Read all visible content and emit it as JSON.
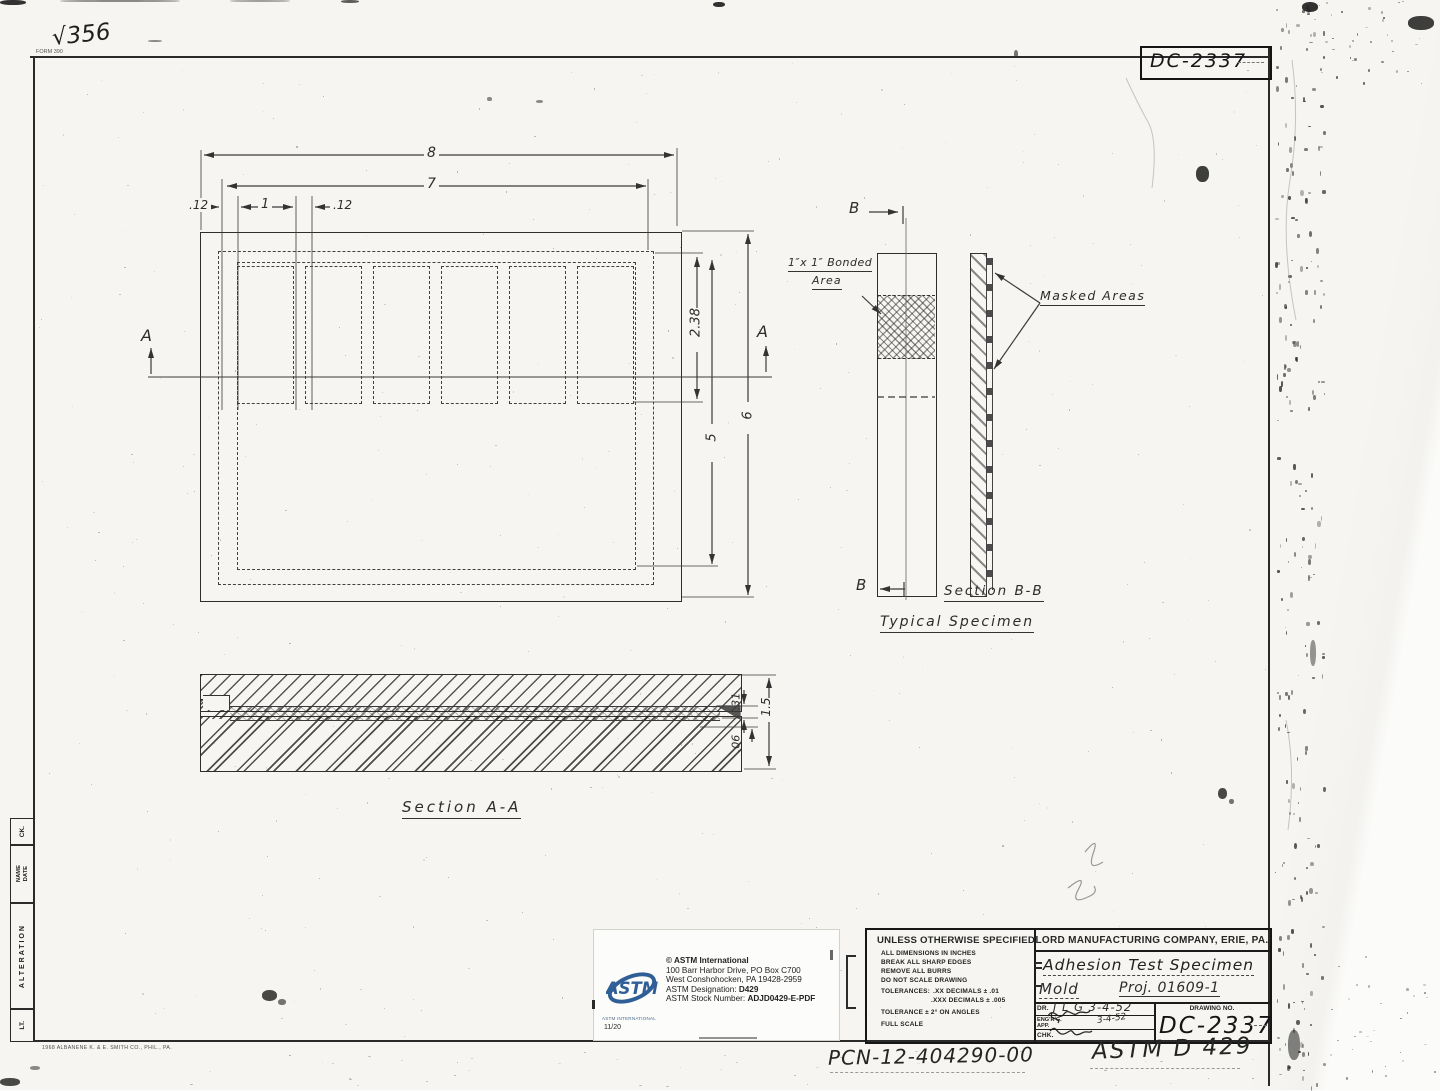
{
  "sheet": {
    "form_no": "FORM 390",
    "page_check": "√356",
    "top_drawing_no": "DC-2337",
    "edge_print": "1968 ALBANENE      K. & E. SMITH CO., PHIL., PA."
  },
  "margin_strip": {
    "ck": "CK.",
    "date": "DATE",
    "name": "NAME",
    "alteration": "ALTERATION",
    "lt": "LT."
  },
  "plan_view": {
    "dim_8": "8",
    "dim_7": "7",
    "dim_12a": ".12",
    "dim_1": "1",
    "dim_12b": ".12",
    "dim_238": "2.38",
    "dim_5": "5",
    "dim_6": "6",
    "section_letter_left": "A",
    "section_letter_right": "A"
  },
  "specimen_view": {
    "section_letter_top": "B",
    "section_letter_bottom": "B",
    "bonded_line1": "1″x 1″ Bonded",
    "bonded_line2": "Area",
    "masked_label": "Masked  Areas",
    "section_title": "Section B-B",
    "subtitle": "Typical Specimen"
  },
  "section_aa": {
    "title": "Section A-A",
    "dim_31": ".31",
    "dim_06": ".06",
    "dim_15": "1.5"
  },
  "astm_label": {
    "logo_text": "ASTM",
    "logo_caption": "ASTM INTERNATIONAL",
    "date_code": "11/20",
    "line1": "© ASTM International",
    "line2": "100 Barr Harbor Drive, PO Box C700",
    "line3": "West Conshohocken, PA  19428-2959",
    "line4_label": "ASTM Designation: ",
    "line4_value": "D429",
    "line5_label": "ASTM Stock Number: ",
    "line5_value": "ADJD0429-E-PDF"
  },
  "title_block": {
    "company": "LORD MANUFACTURING COMPANY, ERIE, PA.",
    "spec_header": "UNLESS OTHERWISE SPECIFIED",
    "spec_lines": [
      "ALL DIMENSIONS IN INCHES",
      "BREAK ALL SHARP EDGES",
      "REMOVE ALL BURRS",
      "DO NOT SCALE DRAWING"
    ],
    "tol_label": "TOLERANCES:",
    "tol_line1": ".XX DECIMALS ± .01",
    "tol_line2": ".XXX DECIMALS ± .005",
    "tol_angle": "TOLERANCE ± 2° ON ANGLES",
    "scale": "FULL SCALE",
    "title_line1": "Adhesion Test Specimen",
    "title_line2": "Mold",
    "proj": "Proj. 01609-1",
    "dr_label": "DR.",
    "dr_value": "J L G 3-4-52",
    "eng_label": "ENG'R'G.",
    "eng_label2": "APP.",
    "eng_date": "3-4-52",
    "chk_label": "CHK.",
    "drawing_no_label": "DRAWING NO.",
    "drawing_no": "DC-2337"
  },
  "annotations": {
    "pcn": "PCN-12-404290-00",
    "astm_ref": "ASTM D 429"
  }
}
